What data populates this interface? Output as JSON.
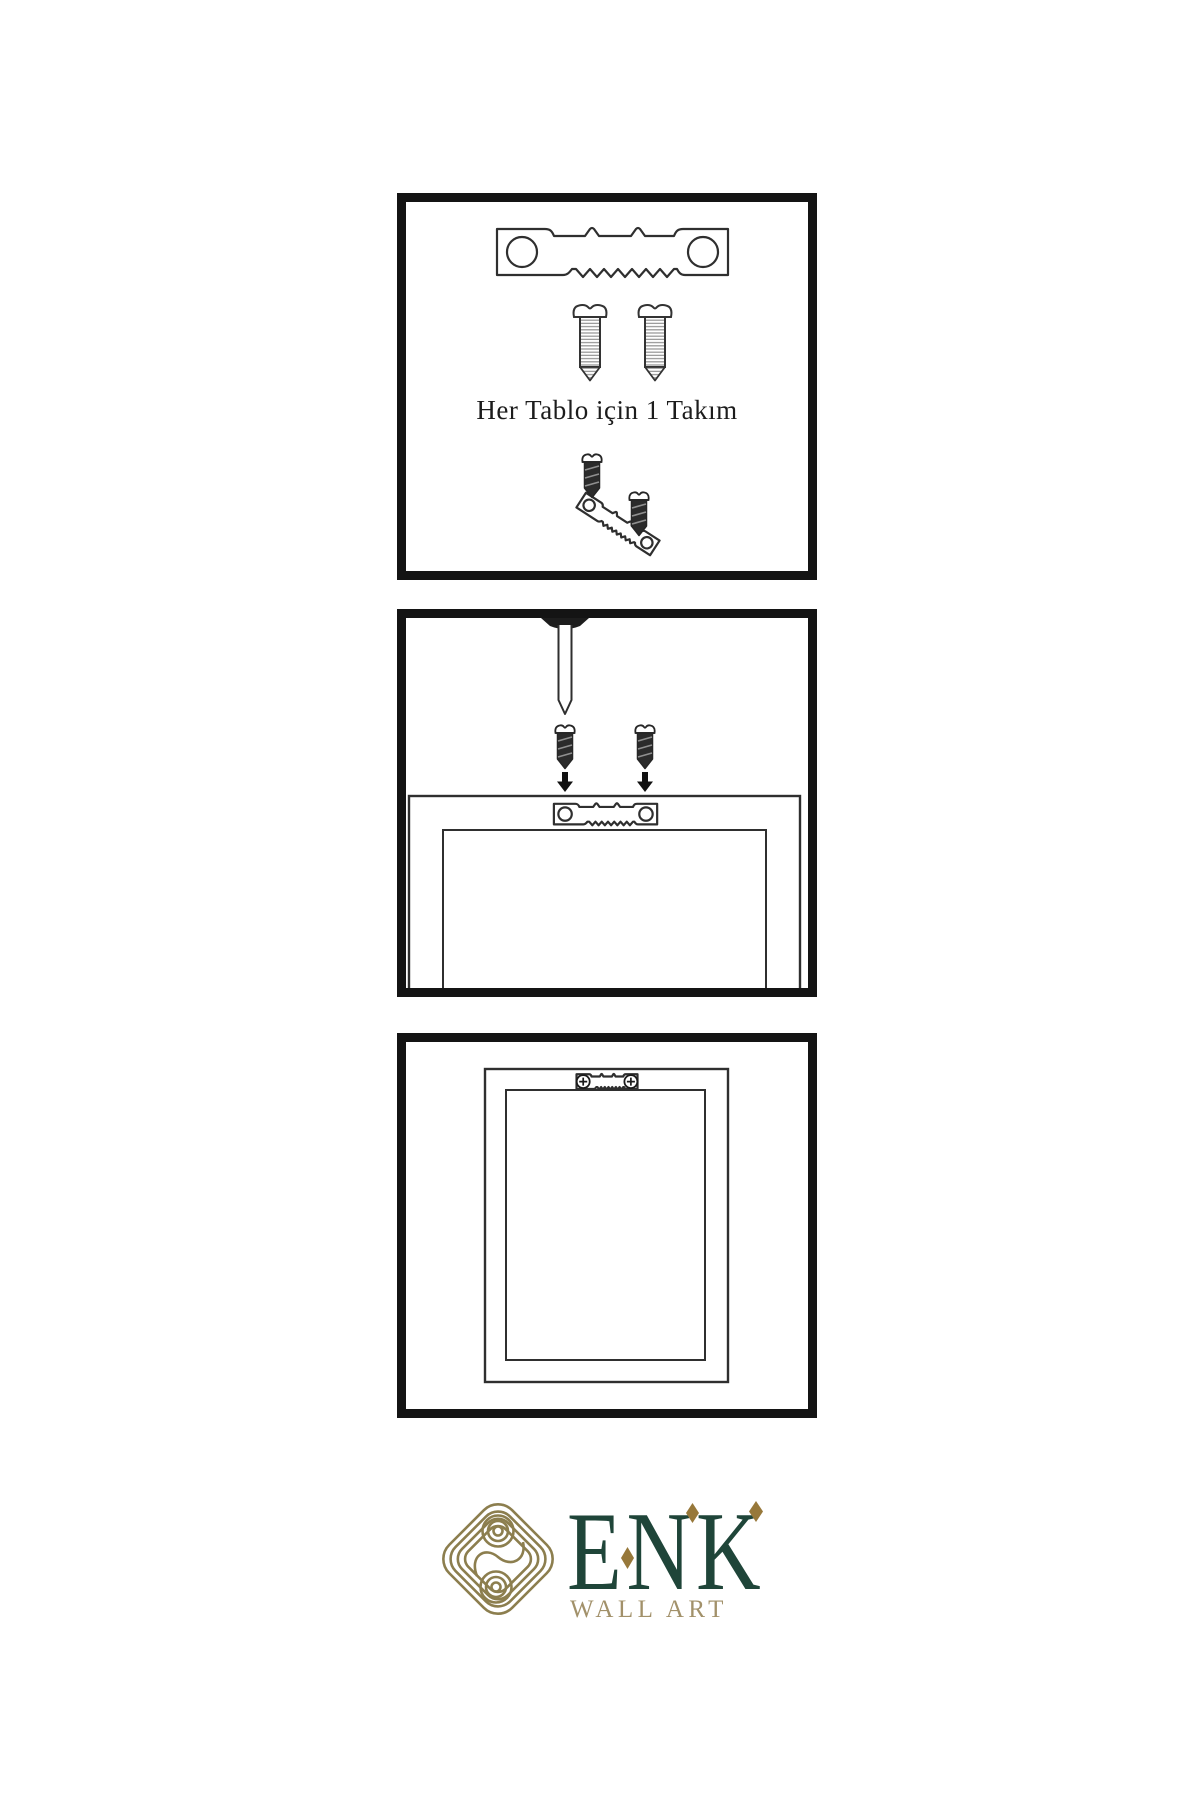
{
  "background": "#ffffff",
  "panels": [
    {
      "name": "hardware-set",
      "caption": "Her Tablo için 1 Takım",
      "icons": [
        "sawtooth-hanger-icon",
        "screw-icon",
        "screw-icon",
        "dark-screw-icon",
        "tilted-sawtooth-hanger-icon",
        "dark-screw-icon"
      ]
    },
    {
      "name": "mounting-step",
      "icons": [
        "nail-icon",
        "dark-screw-icon",
        "dark-screw-icon",
        "down-arrow-icon",
        "down-arrow-icon",
        "frame-back-outline",
        "sawtooth-hanger-icon"
      ]
    },
    {
      "name": "mounted-result",
      "icons": [
        "frame-back-outline",
        "sawtooth-hanger-installed-icon",
        "phillips-screw-icon",
        "phillips-screw-icon"
      ]
    }
  ],
  "logo": {
    "emblem": "knot-emblem-icon",
    "brand": "ENK",
    "subtitle": "WALL ART",
    "colors": {
      "emblem_gold": "#8c7e4e",
      "brand_green": "#1f4539",
      "subtitle_gold": "#a2916a",
      "diamond_gold": "#97783a"
    }
  },
  "line_art": {
    "stroke": "#2f2f2f",
    "panel_border": "#141414",
    "dark_fill": "#2b2b2b"
  }
}
